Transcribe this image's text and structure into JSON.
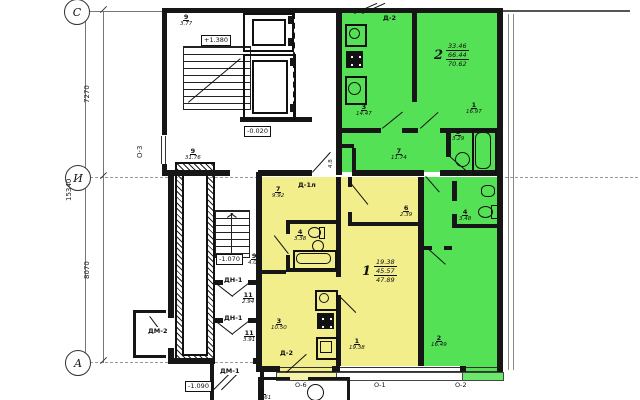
{
  "plan": {
    "axes": {
      "c": "С",
      "i": "И",
      "a": "А"
    },
    "dims": {
      "total": "15340",
      "top": "7270",
      "bottom": "8070"
    },
    "windows": {
      "o3": "О-3",
      "o6": "О-6",
      "o1": "О-1",
      "o2": "О-2"
    },
    "elevations": {
      "stair_top": "+1.380",
      "floor": "-0.020",
      "stair_mid": "-1.070",
      "entry": "-1.090"
    },
    "doors": {
      "d2_top": "Д-2",
      "d1l": "Д-1л",
      "d2_balcony": "Д-2",
      "dn1_upper": "ДН-1",
      "dn1_lower": "ДН-1",
      "dm1": "ДМ-1",
      "dm2": "ДМ-2"
    },
    "colors": {
      "apt1_fill": "#f2ee8c",
      "apt2_fill": "#55e155"
    },
    "apt1": {
      "summary": {
        "num": "1",
        "living": "19.38",
        "heated": "45.57",
        "total": "47.89"
      },
      "rooms": [
        {
          "num": "7",
          "area": "9.92"
        },
        {
          "num": "4",
          "area": "3.38"
        },
        {
          "num": "6",
          "area": "2.39"
        },
        {
          "num": "3",
          "area": "10.50"
        },
        {
          "num": "1",
          "area": "19.38"
        },
        {
          "num": "8",
          "area": "4.61"
        }
      ]
    },
    "apt2": {
      "summary": {
        "num": "2",
        "living": "33.46",
        "heated": "66.44",
        "total": "70.62"
      },
      "storage_area": "4.8",
      "rooms": [
        {
          "num": "3",
          "area": "14.47"
        },
        {
          "num": "1",
          "area": "16.97"
        },
        {
          "num": "7",
          "area": "11.74"
        },
        {
          "num": "5",
          "area": "3.29"
        },
        {
          "num": "4",
          "area": "3.48"
        },
        {
          "num": "2",
          "area": "16.49"
        }
      ]
    },
    "common_rooms": [
      {
        "num": "9",
        "area": "3.77"
      },
      {
        "num": "9",
        "area": "31.76"
      },
      {
        "num": "9",
        "area": "4.07"
      },
      {
        "num": "11",
        "area": "2.94"
      },
      {
        "num": "11",
        "area": "3.91"
      }
    ]
  }
}
